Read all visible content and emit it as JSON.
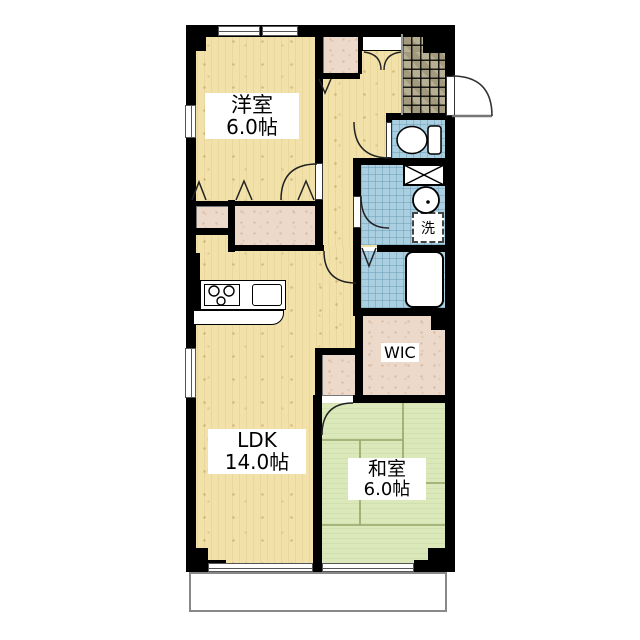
{
  "floorplan": {
    "type": "apartment-floor-plan",
    "rooms": {
      "western_room": {
        "name": "洋室",
        "size": "6.0帖"
      },
      "ldk": {
        "name": "LDK",
        "size": "14.0帖"
      },
      "japanese_room": {
        "name": "和室",
        "size": "6.0帖"
      },
      "wic": {
        "name": "WIC"
      },
      "laundry": {
        "name": "洗"
      }
    },
    "features": [
      "entrance-genkan-tile",
      "toilet",
      "washroom-basin",
      "bathroom-bathtub",
      "kitchen-stove-sink",
      "pipe-space",
      "balcony",
      "closets",
      "walk-in-closet"
    ],
    "colors": {
      "wall": "#000000",
      "wood_floor": "#f2e2aa",
      "closet": "#ecd9ca",
      "entry_tile": "#afa687",
      "wet_area_blue": "#a9cfe1",
      "tatami_green": "#dbe8ba",
      "tatami_line": "#96a468",
      "balcony_line": "#888888"
    }
  }
}
